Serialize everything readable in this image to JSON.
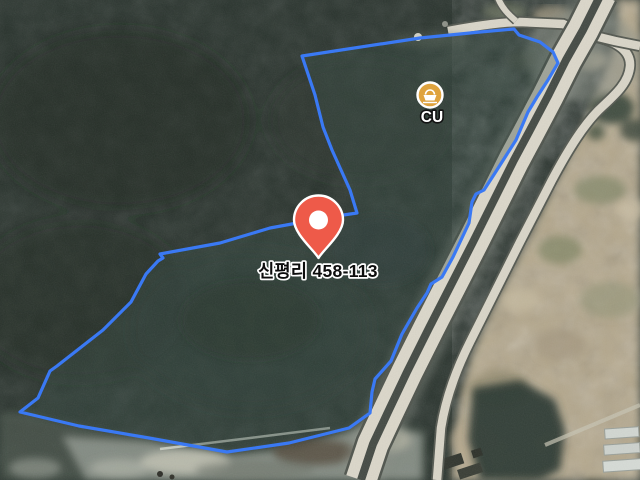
{
  "map": {
    "parcel": {
      "label": "신평리 458-113"
    },
    "poi": {
      "label": "CU"
    }
  },
  "colors": {
    "parcel_outline": "#3a79f4",
    "pin": "#ee5a49",
    "pin_inner": "#ffffff",
    "poi_badge": "#dfa33e",
    "poi_badge_ring": "#ffffff",
    "parcel_label_color": "#0d0d0d",
    "poi_label_color": "#ffffff",
    "road_surface": "#dbd7ca",
    "forest_dark": "#28322c"
  }
}
